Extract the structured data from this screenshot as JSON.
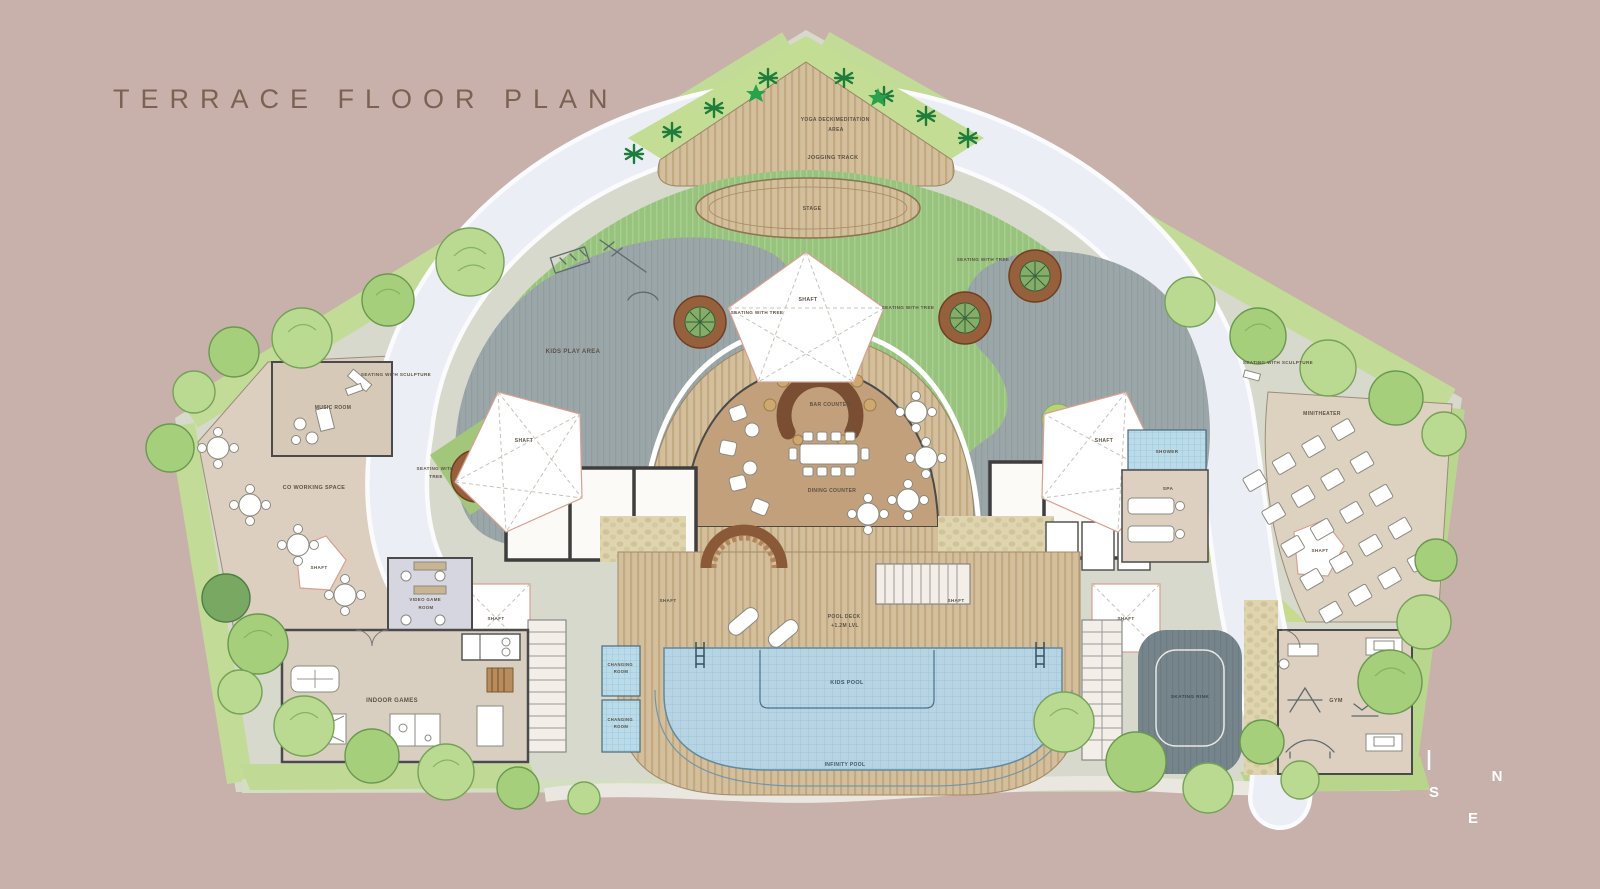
{
  "title": "TERRACE FLOOR PLAN",
  "compass": {
    "n": "N",
    "s": "S",
    "e": "E"
  },
  "colors": {
    "background": "#c8b1ab",
    "title_text": "#7c6253",
    "lawn_green": "#98c37e",
    "jogging_track": "#eceef5",
    "water_blue": "#b6d4e3",
    "wood_deck": "#d4bf9d",
    "play_area_gray": "#9ba6a9",
    "wall_dark": "#3e3e3e",
    "shaft_outline": "#d9a090",
    "compass_text": "#ffffff"
  },
  "areas": {
    "yoga_line1": "YOGA DECK/MEDITATION",
    "yoga_line2": "AREA",
    "jogging_track": "JOGGING TRACK",
    "stage": "STAGE",
    "kids_play_area": "KIDS PLAY AREA",
    "seating_with_tree": "SEATING WITH TREE",
    "seating_with_tree_l1": "SEATING WITH",
    "seating_with_tree_l2": "TREE",
    "seating_with_sculpture": "SEATING WITH SCULPTURE",
    "shaft": "SHAFT",
    "bar_counter": "BAR COUNTER",
    "dining_counter": "DINING COUNTER",
    "music_room": "MUSIC ROOM",
    "co_working_space": "CO WORKING SPACE",
    "video_game_l1": "VIDEO GAME",
    "video_game_l2": "ROOM",
    "indoor_games": "INDOOR GAMES",
    "changing_l1": "CHANGING",
    "changing_l2": "ROOM",
    "pool_deck_l1": "POOL DECK",
    "pool_deck_l2": "+1.2M LVL",
    "kids_pool": "KIDS POOL",
    "infinity_pool": "INFINITY POOL",
    "shower": "SHOWER",
    "spa": "SPA",
    "minitheater": "MINITHEATER",
    "skating_rink": "SKATING RINK",
    "gym": "GYM"
  }
}
